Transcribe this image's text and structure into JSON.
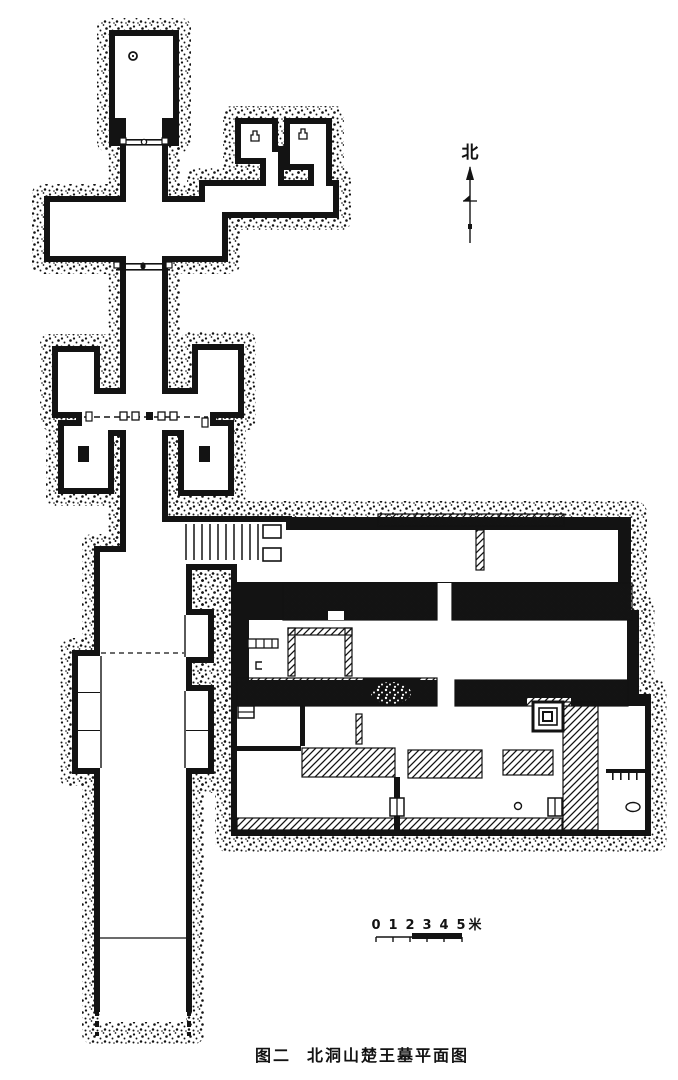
{
  "figure": {
    "caption_prefix": "图二",
    "caption_title": "北洞山楚王墓平面图"
  },
  "north_indicator": {
    "label": "北"
  },
  "scale_bar": {
    "ticks": [
      "0",
      "1",
      "2",
      "3",
      "4",
      "5"
    ],
    "unit": "米"
  },
  "palette": {
    "ink": "#131313",
    "paper": "#ffffff"
  }
}
